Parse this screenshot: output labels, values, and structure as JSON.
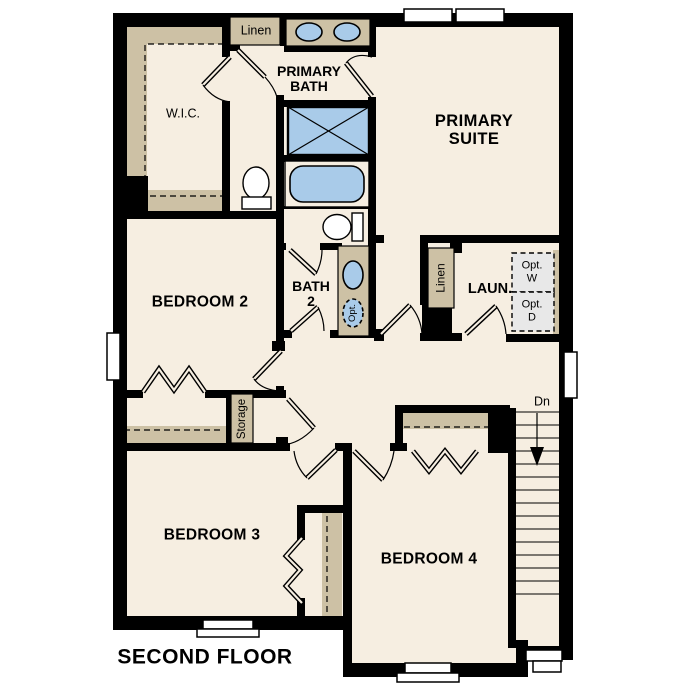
{
  "title": "SECOND FLOOR",
  "labels": {
    "second_floor": "SECOND FLOOR",
    "wic": "W.I.C.",
    "linen_top": "Linen",
    "primary_bath_1": "PRIMARY",
    "primary_bath_2": "BATH",
    "primary_suite_1": "PRIMARY",
    "primary_suite_2": "SUITE",
    "bedroom_2": "BEDROOM 2",
    "bath_2_1": "BATH",
    "bath_2_2": "2",
    "opt_sink": "Opt.",
    "linen_laundry": "Linen",
    "laundry": "LAUN.",
    "opt_washer_1": "Opt.",
    "opt_washer_2": "W",
    "opt_dryer_1": "Opt.",
    "opt_dryer_2": "D",
    "storage": "Storage",
    "stairs_down": "Dn",
    "bedroom_3": "BEDROOM 3",
    "bedroom_4": "BEDROOM 4"
  },
  "colors": {
    "wall": "#000000",
    "floor": "#f6eee1",
    "cabinet": "#cdc1a5",
    "fixture_blue": "#a9cbe9",
    "optional_box": "#e8e8e8",
    "background": "#ffffff"
  }
}
